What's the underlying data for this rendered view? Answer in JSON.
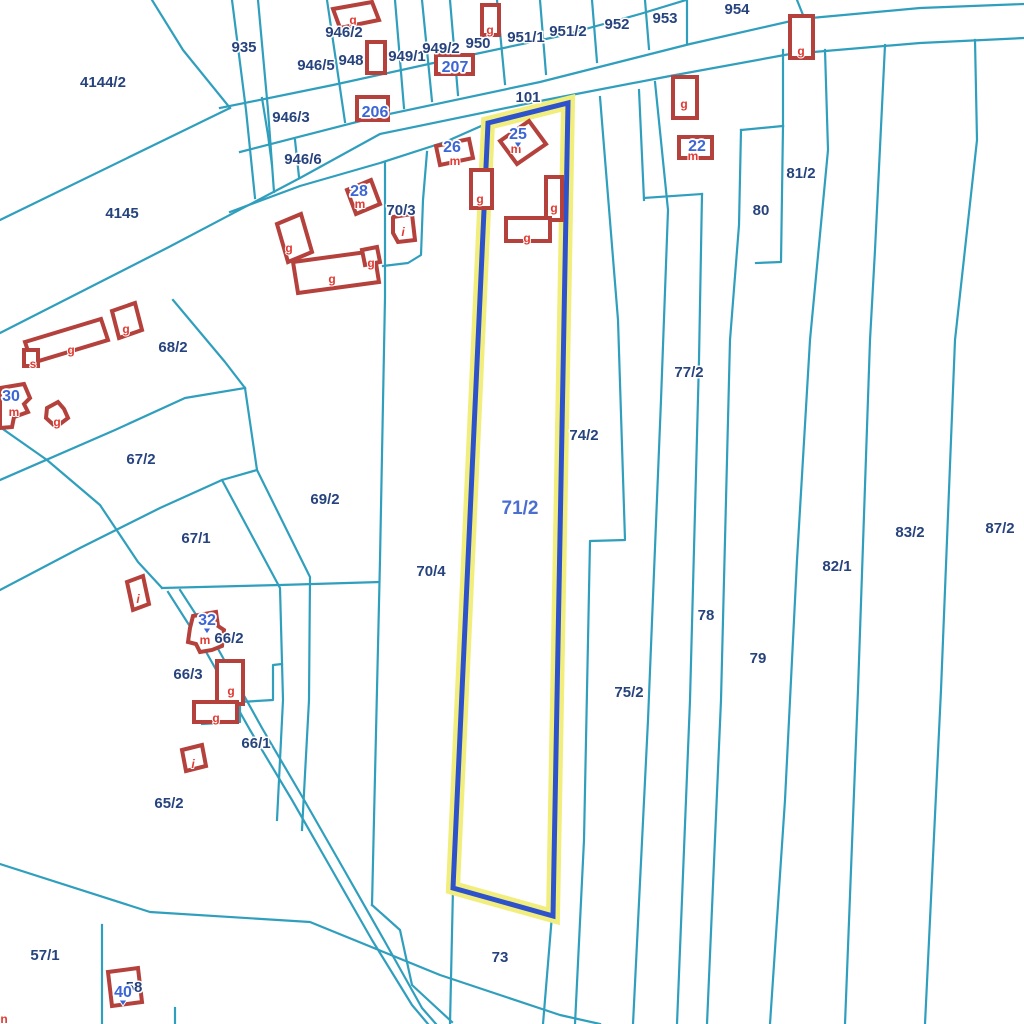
{
  "map": {
    "colors": {
      "background": "#ffffff",
      "boundary": "#2f9fbd",
      "building": "#b5413c",
      "letter": "#e03a32",
      "parcel_label": "#27437e",
      "marker": "#3c66d6",
      "sel_halo": "#f2ee7d",
      "sel_stroke": "#2d52cb",
      "sel_label": "#4a6fce"
    },
    "selected_parcel": {
      "label": "71/2",
      "x": 520,
      "y": 514
    },
    "parcel_labels": [
      {
        "t": "935",
        "x": 244,
        "y": 52
      },
      {
        "t": "4144/2",
        "x": 103,
        "y": 87
      },
      {
        "t": "946/2",
        "x": 344,
        "y": 37
      },
      {
        "t": "946/5",
        "x": 316,
        "y": 70
      },
      {
        "t": "948",
        "x": 351,
        "y": 65
      },
      {
        "t": "949/1",
        "x": 407,
        "y": 61
      },
      {
        "t": "949/2",
        "x": 441,
        "y": 53
      },
      {
        "t": "950",
        "x": 478,
        "y": 48
      },
      {
        "t": "951/1",
        "x": 526,
        "y": 42
      },
      {
        "t": "951/2",
        "x": 568,
        "y": 36
      },
      {
        "t": "952",
        "x": 617,
        "y": 29
      },
      {
        "t": "953",
        "x": 665,
        "y": 23
      },
      {
        "t": "954",
        "x": 737,
        "y": 14
      },
      {
        "t": "101",
        "x": 528,
        "y": 102
      },
      {
        "t": "946/3",
        "x": 291,
        "y": 122
      },
      {
        "t": "946/6",
        "x": 303,
        "y": 164
      },
      {
        "t": "4145",
        "x": 122,
        "y": 218
      },
      {
        "t": "70/3",
        "x": 401,
        "y": 215
      },
      {
        "t": "68/2",
        "x": 173,
        "y": 352
      },
      {
        "t": "67/2",
        "x": 141,
        "y": 464
      },
      {
        "t": "67/1",
        "x": 196,
        "y": 543
      },
      {
        "t": "69/2",
        "x": 325,
        "y": 504
      },
      {
        "t": "70/4",
        "x": 431,
        "y": 576
      },
      {
        "t": "74/2",
        "x": 584,
        "y": 440
      },
      {
        "t": "77/2",
        "x": 689,
        "y": 377
      },
      {
        "t": "80",
        "x": 761,
        "y": 215
      },
      {
        "t": "81/2",
        "x": 801,
        "y": 178
      },
      {
        "t": "82/1",
        "x": 837,
        "y": 571
      },
      {
        "t": "83/2",
        "x": 910,
        "y": 537
      },
      {
        "t": "87/2",
        "x": 1000,
        "y": 533
      },
      {
        "t": "78",
        "x": 706,
        "y": 620
      },
      {
        "t": "79",
        "x": 758,
        "y": 663
      },
      {
        "t": "75/2",
        "x": 629,
        "y": 697
      },
      {
        "t": "66/2",
        "x": 229,
        "y": 643
      },
      {
        "t": "66/3",
        "x": 188,
        "y": 679
      },
      {
        "t": "66/1",
        "x": 256,
        "y": 748
      },
      {
        "t": "65/2",
        "x": 169,
        "y": 808
      },
      {
        "t": "57/1",
        "x": 45,
        "y": 960
      },
      {
        "t": "73",
        "x": 500,
        "y": 962
      },
      {
        "t": "58",
        "x": 134,
        "y": 992
      }
    ],
    "address_markers": [
      {
        "t": "206",
        "x": 375,
        "y": 117,
        "anchor": false
      },
      {
        "t": "207",
        "x": 455,
        "y": 72,
        "anchor": false
      },
      {
        "t": "26",
        "x": 452,
        "y": 152,
        "anchor": false
      },
      {
        "t": "25",
        "x": 518,
        "y": 139,
        "anchor": true
      },
      {
        "t": "28",
        "x": 359,
        "y": 196,
        "anchor": false
      },
      {
        "t": "30",
        "x": 11,
        "y": 401,
        "anchor": false
      },
      {
        "t": "32",
        "x": 207,
        "y": 625,
        "anchor": true
      },
      {
        "t": "22",
        "x": 697,
        "y": 151,
        "anchor": false
      },
      {
        "t": "40",
        "x": 123,
        "y": 997,
        "anchor": true
      }
    ],
    "building_letters": [
      {
        "t": "g",
        "x": 353,
        "y": 24
      },
      {
        "t": "g",
        "x": 490,
        "y": 34
      },
      {
        "t": "g",
        "x": 684,
        "y": 108
      },
      {
        "t": "g",
        "x": 801,
        "y": 55
      },
      {
        "t": "m",
        "x": 455,
        "y": 165
      },
      {
        "t": "m",
        "x": 516,
        "y": 153
      },
      {
        "t": "g",
        "x": 480,
        "y": 203
      },
      {
        "t": "g",
        "x": 554,
        "y": 212
      },
      {
        "t": "g",
        "x": 527,
        "y": 242
      },
      {
        "t": "m",
        "x": 360,
        "y": 208
      },
      {
        "t": "i",
        "x": 403,
        "y": 236,
        "italic": true
      },
      {
        "t": "g",
        "x": 289,
        "y": 252
      },
      {
        "t": "g",
        "x": 332,
        "y": 283
      },
      {
        "t": "g",
        "x": 371,
        "y": 267
      },
      {
        "t": "g",
        "x": 71,
        "y": 354
      },
      {
        "t": "s",
        "x": 33,
        "y": 368
      },
      {
        "t": "g",
        "x": 126,
        "y": 333
      },
      {
        "t": "m",
        "x": 14,
        "y": 416
      },
      {
        "t": "g",
        "x": 57,
        "y": 426
      },
      {
        "t": "m",
        "x": 693,
        "y": 160
      },
      {
        "t": "m",
        "x": 205,
        "y": 644
      },
      {
        "t": "g",
        "x": 231,
        "y": 695
      },
      {
        "t": "g",
        "x": 216,
        "y": 722
      },
      {
        "t": "i",
        "x": 138,
        "y": 603,
        "italic": true
      },
      {
        "t": "i",
        "x": 193,
        "y": 768,
        "italic": true
      },
      {
        "t": "n",
        "x": 4,
        "y": 1023
      }
    ]
  }
}
